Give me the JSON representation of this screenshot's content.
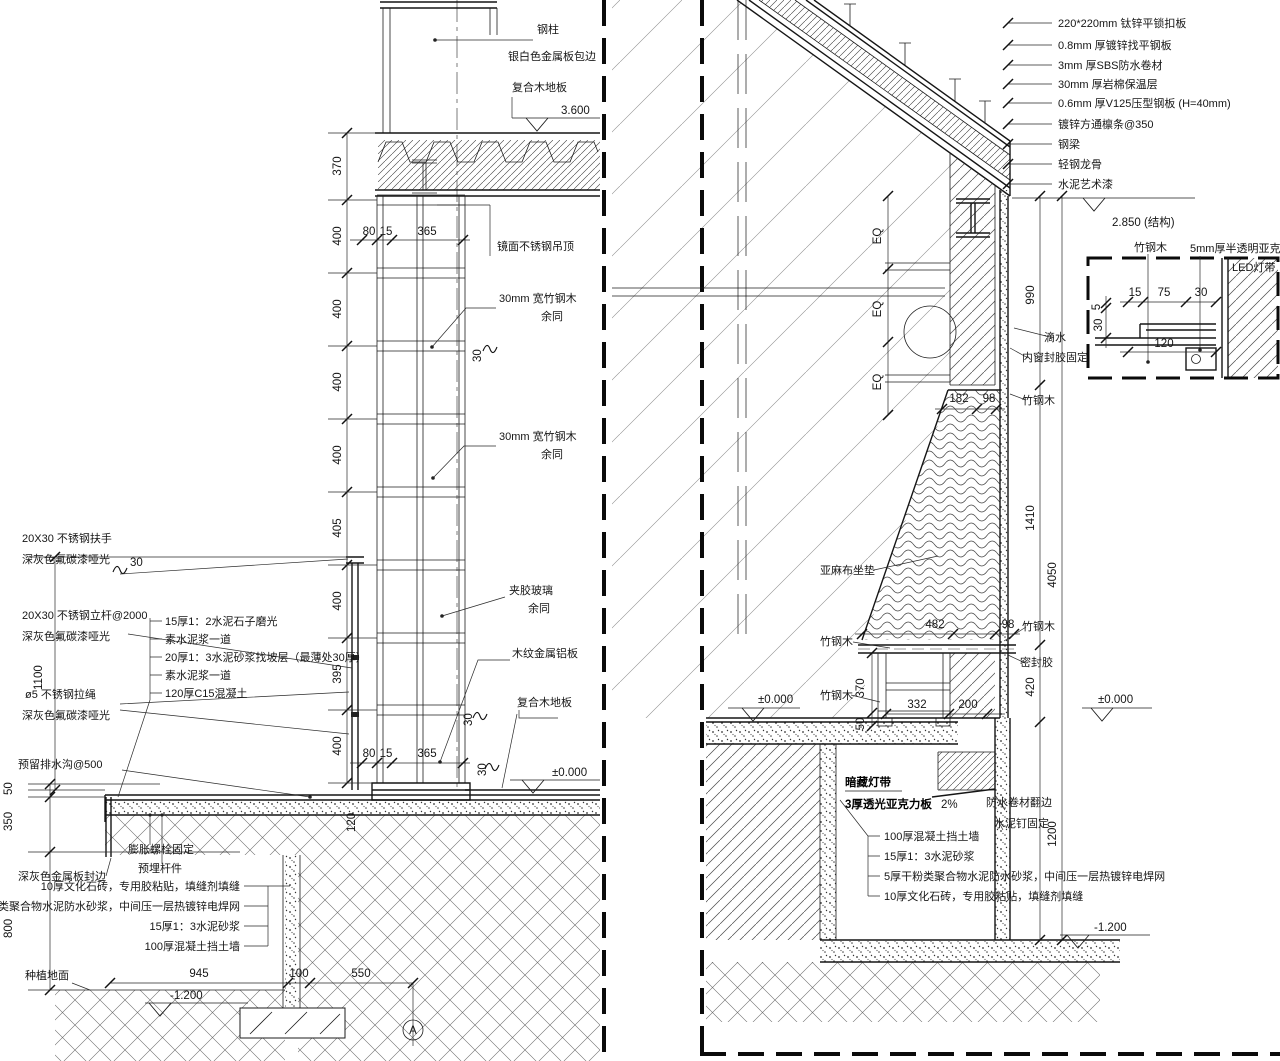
{
  "left": {
    "col_label": "钢柱",
    "col_edge": "银白色金属板包边",
    "wood_floor": "复合木地板",
    "elev_3600": "3.600",
    "mirror_ceiling": "镜面不锈钢吊顶",
    "bamboo_30": "30mm 宽竹钢木",
    "same_as": "余同",
    "glass": "夹胶玻璃",
    "wood_metal_panel": "木纹金属铝板",
    "elev_0": "±0.000",
    "floor_layers": [
      "15厚1：2水泥石子磨光",
      "素水泥浆一道",
      "20厚1：3水泥砂浆找坡层（最薄处30厚）",
      "素水泥浆一道",
      "120厚C15混凝土"
    ],
    "rail_handrail": "20X30 不锈钢扶手",
    "rail_paint": "深灰色氟碳漆哑光",
    "rail_post": "20X30 不锈钢立杆@2000",
    "rail_cable": "ø5 不锈钢拉绳",
    "drain": "预留排水沟@500",
    "bolt": "膨胀螺栓固定",
    "embed": "预埋杆件",
    "metal_edge": "深灰色金属板封边",
    "wall_layers": [
      "10厚文化石砖，专用胶粘贴，填缝剂填缝",
      "5厚干粉类聚合物水泥防水砂浆，中间压一层热镀锌电焊网",
      "15厚1：3水泥砂浆",
      "100厚混凝土挡土墙"
    ],
    "planting": "种植地面",
    "elev_m1200": "-1.200",
    "grid": "A",
    "chain": [
      "370",
      "400",
      "400",
      "400",
      "400",
      "405",
      "400",
      "395",
      "400"
    ]
  },
  "right": {
    "roof_layers": [
      "220*220mm 钛锌平锁扣板",
      "0.8mm 厚镀锌找平钢板",
      "3mm 厚SBS防水卷材",
      "30mm 厚岩棉保温层",
      "0.6mm 厚V125压型钢板 (H=40mm)",
      "镀锌方通檩条@350",
      "钢梁",
      "轻钢龙骨",
      "水泥艺术漆"
    ],
    "elev_2850": "2.850 (结构)",
    "bamboo": "竹钢木",
    "acrylic_5mm": "5mm厚半透明亚克力",
    "led": "LED灯带",
    "drip": "滴水",
    "inner_seal": "内窗封胶固定",
    "sealant": "密封胶",
    "cushion": "亚麻布坐垫",
    "elev_0": "±0.000",
    "hidden_light": "暗藏灯带",
    "acrylic_3": "3厚透光亚克力板",
    "slope": "2%",
    "wp_flange": "防水卷材翻边",
    "nail": "水泥钉固定",
    "wall_layers": [
      "100厚混凝土挡土墙",
      "15厚1：3水泥砂浆",
      "5厚干粉类聚合物水泥防水砂浆，中间压一层热镀锌电焊网",
      "10厚文化石砖，专用胶粘贴，填缝剂填缝"
    ],
    "elev_m1200": "-1.200",
    "eq": "EQ"
  },
  "dims": {
    "d370": "370",
    "d400": "400",
    "d405": "405",
    "d395": "395",
    "d80": "80",
    "d15": "15",
    "d365": "365",
    "d30": "30",
    "d1100": "1100",
    "d50": "50",
    "d350": "350",
    "d800": "800",
    "d120": "120",
    "d945": "945",
    "d100": "100",
    "d550": "550",
    "d990": "990",
    "d1410": "1410",
    "d4050": "4050",
    "d182": "182",
    "d98": "98",
    "d482": "482",
    "d332": "332",
    "d200": "200",
    "d420": "420",
    "d1200": "1200",
    "d75": "75",
    "d5": "5"
  }
}
